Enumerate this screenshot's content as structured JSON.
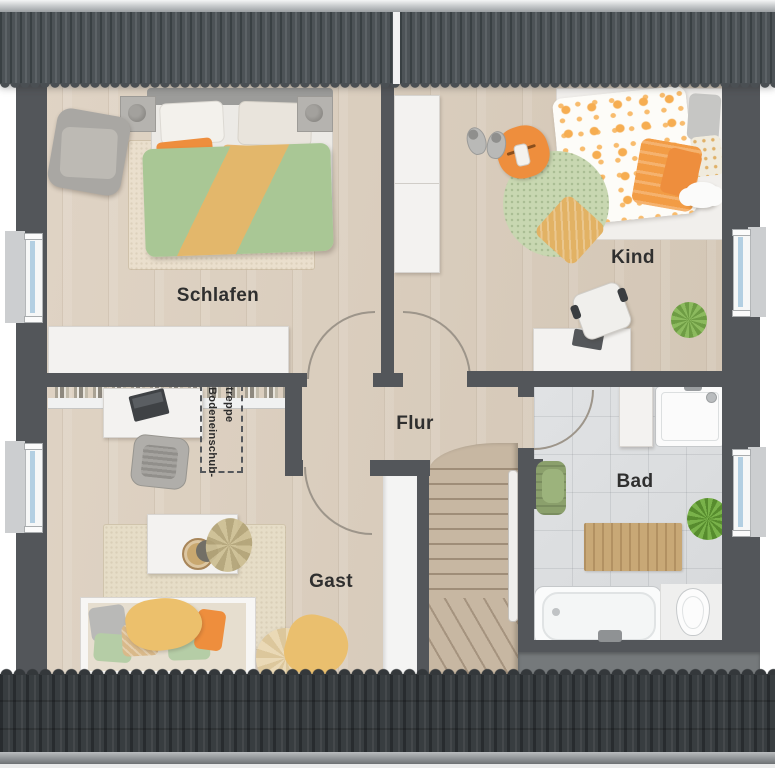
{
  "rooms": [
    {
      "id": "schlafen",
      "label": "Schlafen"
    },
    {
      "id": "kind",
      "label": "Kind"
    },
    {
      "id": "flur",
      "label": "Flur"
    },
    {
      "id": "gast",
      "label": "Gast"
    },
    {
      "id": "bad",
      "label": "Bad"
    }
  ],
  "annotations": {
    "attic_hatch": {
      "line1": "Bodeneinschub-",
      "line2": "treppe"
    }
  },
  "colors": {
    "wall": "#53565a",
    "floor_wood_a": "#e0d4c5",
    "floor_wood_b": "#d2c5b4",
    "tile": "#d7d9db",
    "stairs": "#c7b7a2",
    "white_f": "#f3f2f0",
    "glass": "#b3cfe2",
    "orange": "#ee8e3d",
    "green": "#a9c795",
    "yellow": "#e3b76b",
    "rug_a": "#eadfcd",
    "rug_b": "#e6ddc7",
    "text": "#2f2f2f"
  }
}
